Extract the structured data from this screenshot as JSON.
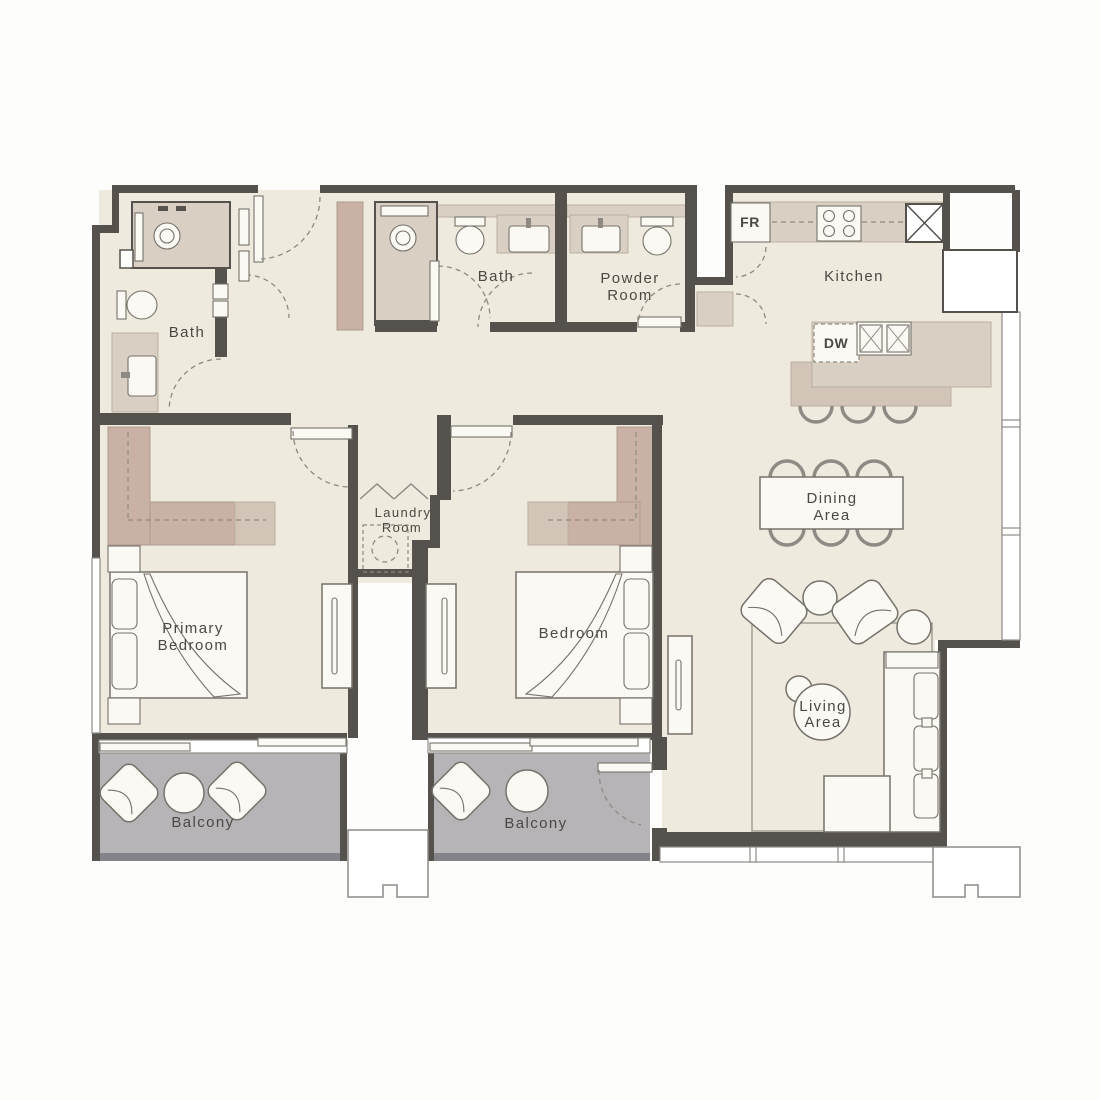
{
  "labels": {
    "bath_primary": "Bath",
    "bath_shared": "Bath",
    "powder": [
      "Powder",
      "Room"
    ],
    "kitchen": "Kitchen",
    "fridge": "FR",
    "dishwasher": "DW",
    "dining": [
      "Dining",
      "Area"
    ],
    "living": [
      "Living",
      "Area"
    ],
    "laundry": [
      "Laundry",
      "Room"
    ],
    "primary_bedroom": [
      "Primary",
      "Bedroom"
    ],
    "bedroom": "Bedroom",
    "balcony_primary": "Balcony",
    "balcony_bedroom": "Balcony"
  },
  "theme": {
    "floor": "#eeeadd",
    "wall": "#55524d",
    "balcony": "#b6b4b7",
    "balcony-edge": "#85838a",
    "mauve": "#c9b1a6",
    "taupe": "#d9cfc3",
    "taupe2": "#d2c5b8",
    "furn": "#fbf9f3",
    "line": "#76726b",
    "dash": "#8e8a83",
    "text": "#4b4844",
    "win": "#8e8b86",
    "rug": "#a7a39b"
  }
}
